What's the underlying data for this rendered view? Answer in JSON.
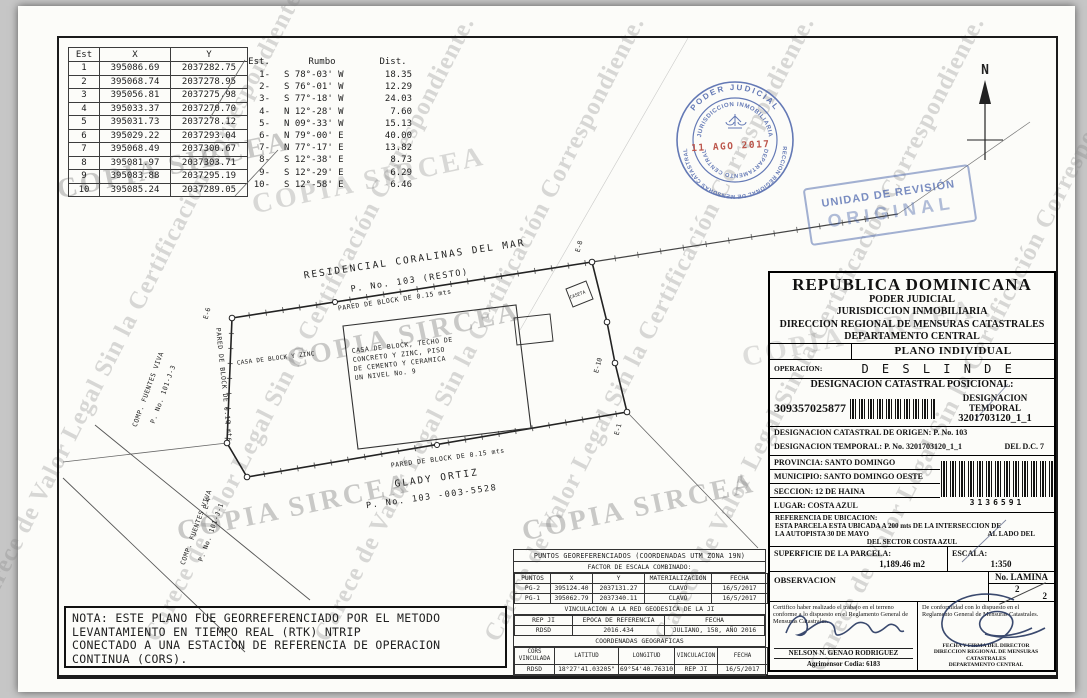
{
  "watermark": {
    "diagonal_text": "Carece de Valor Legal Sin la Certificación Correspondiente.",
    "copy_stamp": "COPIA SIRCEA"
  },
  "coord_table": {
    "headers": [
      "Est",
      "X",
      "Y"
    ],
    "rows": [
      [
        "1",
        "395086.69",
        "2037282.75"
      ],
      [
        "2",
        "395068.74",
        "2037278.95"
      ],
      [
        "3",
        "395056.81",
        "2037275.98"
      ],
      [
        "4",
        "395033.37",
        "2037270.70"
      ],
      [
        "5",
        "395031.73",
        "2037278.12"
      ],
      [
        "6",
        "395029.22",
        "2037293.04"
      ],
      [
        "7",
        "395068.49",
        "2037300.67"
      ],
      [
        "8",
        "395081.97",
        "2037303.71"
      ],
      [
        "9",
        "395083.88",
        "2037295.19"
      ],
      [
        "10",
        "395085.24",
        "2037289.05"
      ]
    ]
  },
  "bearing_table": {
    "headers": [
      "Est.",
      "Rumbo",
      "Dist."
    ],
    "rows": [
      [
        "1-",
        "S 78°-03' W",
        "18.35"
      ],
      [
        "2-",
        "S 76°-01' W",
        "12.29"
      ],
      [
        "3-",
        "S 77°-18' W",
        "24.03"
      ],
      [
        "4-",
        "N 12°-28' W",
        "7.60"
      ],
      [
        "5-",
        "N 09°-33' W",
        "15.13"
      ],
      [
        "6-",
        "N 79°-00' E",
        "40.00"
      ],
      [
        "7-",
        "N 77°-17' E",
        "13.82"
      ],
      [
        "8-",
        "S 12°-38' E",
        "8.73"
      ],
      [
        "9-",
        "S 12°-29' E",
        "6.29"
      ],
      [
        "10-",
        "S 12°-58' E",
        "6.46"
      ]
    ]
  },
  "drawing": {
    "north": "N",
    "residencial": "RESIDENCIAL CORALINAS DEL MAR",
    "resto": "P. No. 103 (RESTO)",
    "pared_top": "PARED DE BLOCK DE 0.15 mts",
    "pared_bottom": "PARED DE BLOCK DE 0.15 mts",
    "pared_left": "PARED DE BLOCK DE 0.10 mts",
    "casa_zinc": "CASA DE BLOCK Y ZINC",
    "casa_l1": "CASA DE BLOCK, TECHO DE",
    "casa_l2": "CONCRETO Y ZINC, PISO",
    "casa_l3": "DE CEMENTO Y CERAMICA",
    "casa_l4": "UN NIVEL No. 9",
    "caseta": "CASETA",
    "glady_1": "GLADY ORTIZ",
    "glady_2": "P. No. 103 -003-5528",
    "comp_upper_1": "COMP. FUENTES VIVA",
    "comp_upper_2": "P. No. 101-J-3",
    "comp_lower_1": "COMP. FUENTES VIVA",
    "comp_lower_2": "P. No. 101-J-1",
    "e1": "E-1",
    "e4": "E-4",
    "e6": "E-6",
    "e8": "E-8",
    "e10": "E-10"
  },
  "stamps": {
    "round": {
      "outer_top": "PODER JUDICIAL",
      "outer_bottom": "DIRECCION REGIONAL DE MENSURAS CATASTRALES",
      "inner_top": "JURISDICCION INMOBILIARIA",
      "inner_bottom": "DEPARTAMENTO CENTRAL",
      "date": "11 AGO 2017"
    },
    "revision": {
      "line1": "UNIDAD DE REVISIÓN",
      "line2": "ORIGINAL"
    }
  },
  "panel": {
    "country": "REPUBLICA DOMINICANA",
    "org1": "PODER JUDICIAL",
    "org2": "JURISDICCION INMOBILIARIA",
    "org3": "DIRECCION REGIONAL DE MENSURAS CATASTRALES",
    "org4": "DEPARTAMENTO CENTRAL",
    "plan_type": "PLANO INDIVIDUAL",
    "operation_label": "OPERACION:",
    "operation_value": "D E S L I N D E",
    "designation_header": "DESIGNACION CATASTRAL POSICIONAL:",
    "positional_number": "309357025877",
    "temporal_label": "DESIGNACION TEMPORAL",
    "temporal_number": "3201703120_1_1",
    "origin_line": "DESIGNACION CATASTRAL DE ORIGEN: P. No. 103",
    "temporal_line": "DESIGNACION TEMPORAL: P. No. 3201703120_1_1",
    "district": "DEL D.C. 7",
    "provincia": "PROVINCIA: SANTO DOMINGO",
    "municipio": "MUNICIPIO: SANTO DOMINGO OESTE",
    "seccion": "SECCION: 12 DE HAINA",
    "lugar": "LUGAR: COSTA AZUL",
    "barcode_number": "3136591",
    "referencia": {
      "label": "REFERENCIA DE UBICACION:",
      "line1": "ESTA PARCELA ESTA UBICADA A 200 mts DE LA INTERSECCION DE",
      "line2_left": "LA AUTOPISTA 30 DE MAYO",
      "line2_right": "AL LADO DEL",
      "line3": "DEL SECTOR COSTA AZUL"
    },
    "superficie_label": "SUPERFICIE DE LA PARCELA:",
    "superficie_value": "1,189.46 m2",
    "escala_label": "ESCALA:",
    "escala_value": "1:350",
    "observacion_label": "OBSERVACION",
    "lamina_label": "No. LAMINA",
    "lamina_top": "2",
    "lamina_bottom": "2",
    "cert_left": "Certifico haber realizado el trabajo en el terreno conforme a lo dispuesto en el Reglamento General de Mensuras Catastrales.",
    "cert_right": "De conformidad con lo dispuesto en el Reglamento General de Mensuras Catastrales.",
    "surveyor_name": "NELSON N. GENAO RODRIGUEZ",
    "surveyor_code": "Agrimensor Codia: 6183",
    "director_line1": "FECHA Y FIRMA DEL DIRECTOR",
    "director_line2": "DIRECCION REGIONAL DE MENSURAS CATASTRALES",
    "director_line3": "DEPARTAMENTO CENTRAL"
  },
  "geo_table": {
    "title": "PUNTOS GEOREFERENCIADOS (COORDENADAS UTM ZONA 19N)",
    "subtitle": "FACTOR DE ESCALA COMBINADO:",
    "headers": [
      "PUNTOS",
      "X",
      "Y",
      "MATERIALIZACION",
      "FECHA"
    ],
    "rows": [
      [
        "PG-2",
        "395124.40",
        "2037131.27",
        "CLAVO",
        "16/5/2017"
      ],
      [
        "PG-1",
        "395062.79",
        "2037340.11",
        "CLAVO",
        "16/5/2017"
      ]
    ],
    "vinc_title": "VINCULACION A LA RED GEODESICA DE LA JI",
    "vinc_headers": [
      "REP JI",
      "EPOCA DE REFERENCIA",
      "FECHA"
    ],
    "vinc_rows": [
      [
        "RDSD",
        "2016.434",
        "JULIANO, 158, AÑO 2016"
      ]
    ],
    "geo_title": "COORDENADAS GEOGRAFICAS",
    "geo_headers": [
      "CORS VINCULADA",
      "LATITUD",
      "LONGITUD",
      "VINCULACION",
      "FECHA"
    ],
    "geo_rows": [
      [
        "RDSD",
        "18°27'41.03205\"",
        "69°54'40.76310",
        "REP JI",
        "16/5/2017"
      ]
    ]
  },
  "nota": {
    "lines": [
      "NOTA: ESTE PLANO FUE GEORREFERENCIADO POR EL METODO",
      "LEVANTAMIENTO EN TIEMPO REAL (RTK) NTRIP",
      "CONECTADO A UNA ESTACION DE REFERENCIA DE OPERACION",
      "CONTINUA (CORS)."
    ]
  }
}
